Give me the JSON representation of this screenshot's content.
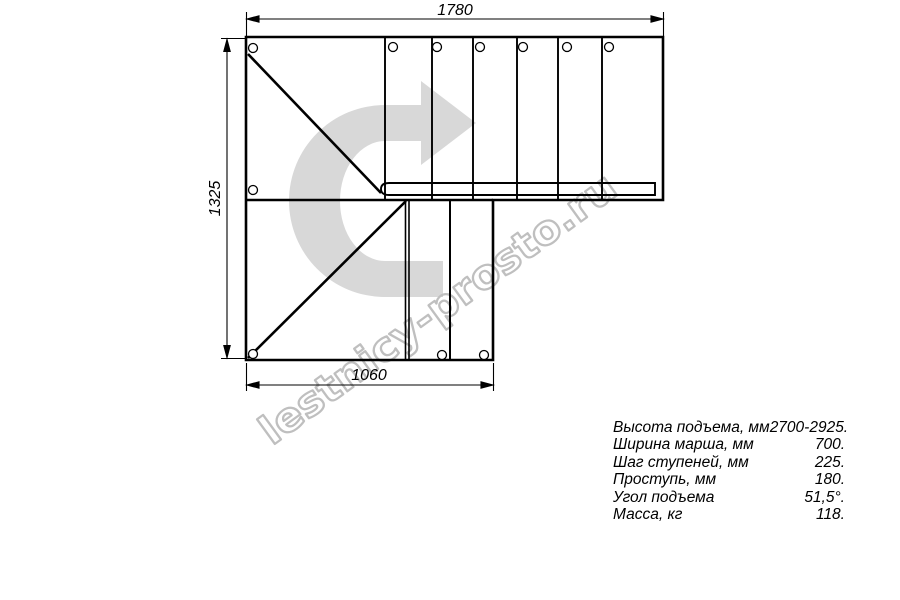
{
  "drawing": {
    "title": "staircase-plan",
    "dimensions": {
      "top": "1780",
      "left": "1325",
      "bottom": "1060"
    },
    "watermark": "lestnicy-prosto.ru",
    "colors": {
      "arrow_fill": "#d8d8d8",
      "watermark_stroke": "#bfbfbf",
      "line": "#000000"
    }
  },
  "specs": {
    "rows": [
      {
        "label": "Высота подъема, мм",
        "value": "2700-2925."
      },
      {
        "label": "Ширина марша, мм",
        "value": "700."
      },
      {
        "label": "Шаг ступеней, мм",
        "value": "225."
      },
      {
        "label": "Проступь, мм",
        "value": "180."
      },
      {
        "label": "Угол подъема",
        "value": "51,5°."
      },
      {
        "label": "Масса, кг",
        "value": "118."
      }
    ]
  }
}
